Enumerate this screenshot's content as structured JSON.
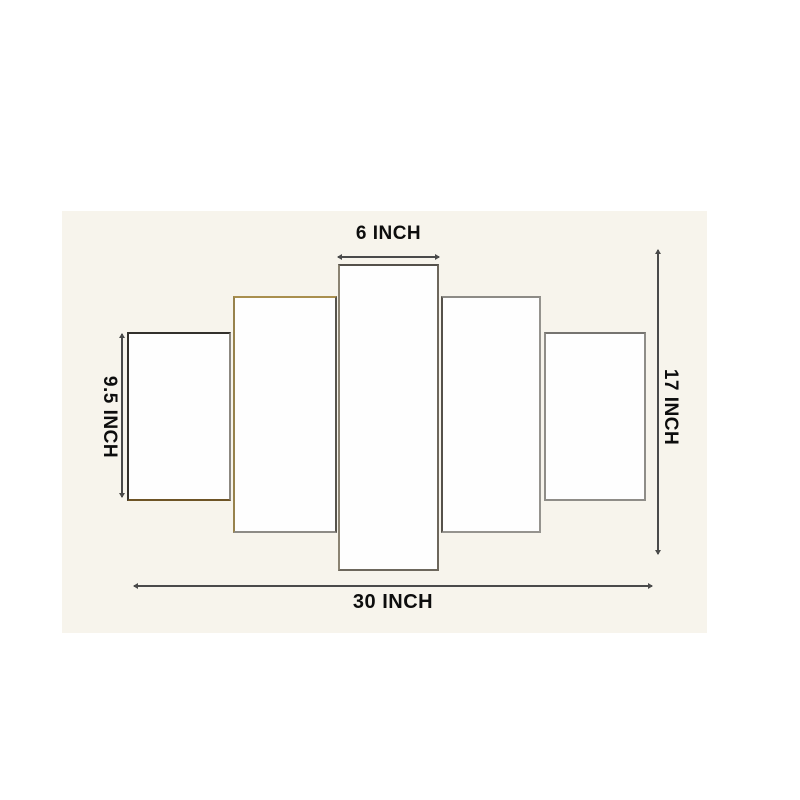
{
  "diagram": {
    "type": "product-dimension-diagram",
    "panel_count": 5,
    "labels": {
      "center_panel_width": "6 INCH",
      "side_panel_height": "9.5 INCH",
      "total_height": "17 INCH",
      "total_width": "30 INCH"
    },
    "colors": {
      "page_background": "#ffffff",
      "photo_background": "#f7f4ec",
      "panel_fill": "#fefefe",
      "panel_edge_dark": "#33302c",
      "panel_edge_gray": "#8f8d88",
      "gold_edge_accent": "#a98f4e",
      "dimension_line": "#4a4a4a",
      "label_text": "#0d0d0d"
    }
  }
}
